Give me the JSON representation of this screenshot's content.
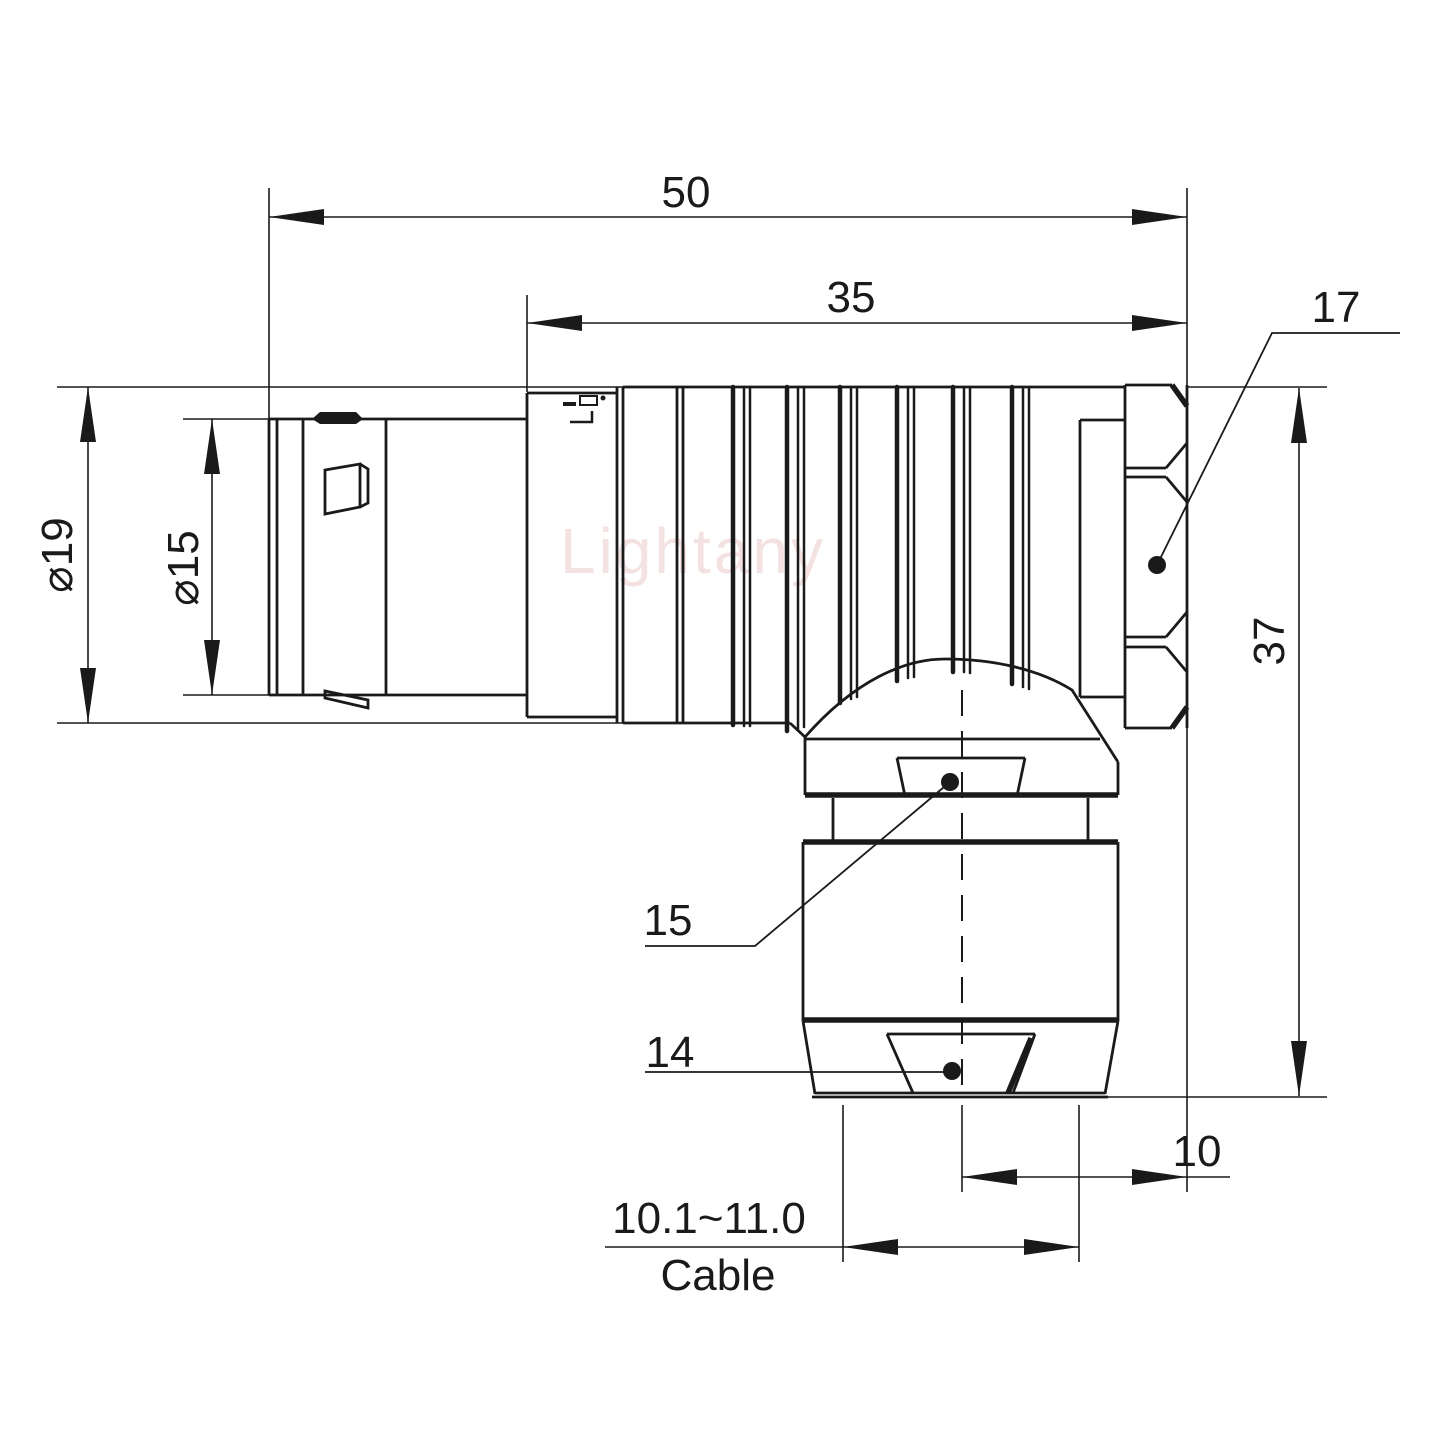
{
  "watermark": "Lightany",
  "dimensions": {
    "total_length": "50",
    "rear_length": "35",
    "hex_width": "17",
    "outer_diameter": "⌀19",
    "sleeve_diameter": "⌀15",
    "height": "37",
    "clamp_label": "15",
    "cone_label": "14",
    "offset": "10",
    "cable_diameter_range": "10.1~11.0",
    "cable_caption": "Cable"
  },
  "colors": {
    "line": "#1a1a1a",
    "watermark": "#e7b9b9",
    "background": "#ffffff"
  }
}
